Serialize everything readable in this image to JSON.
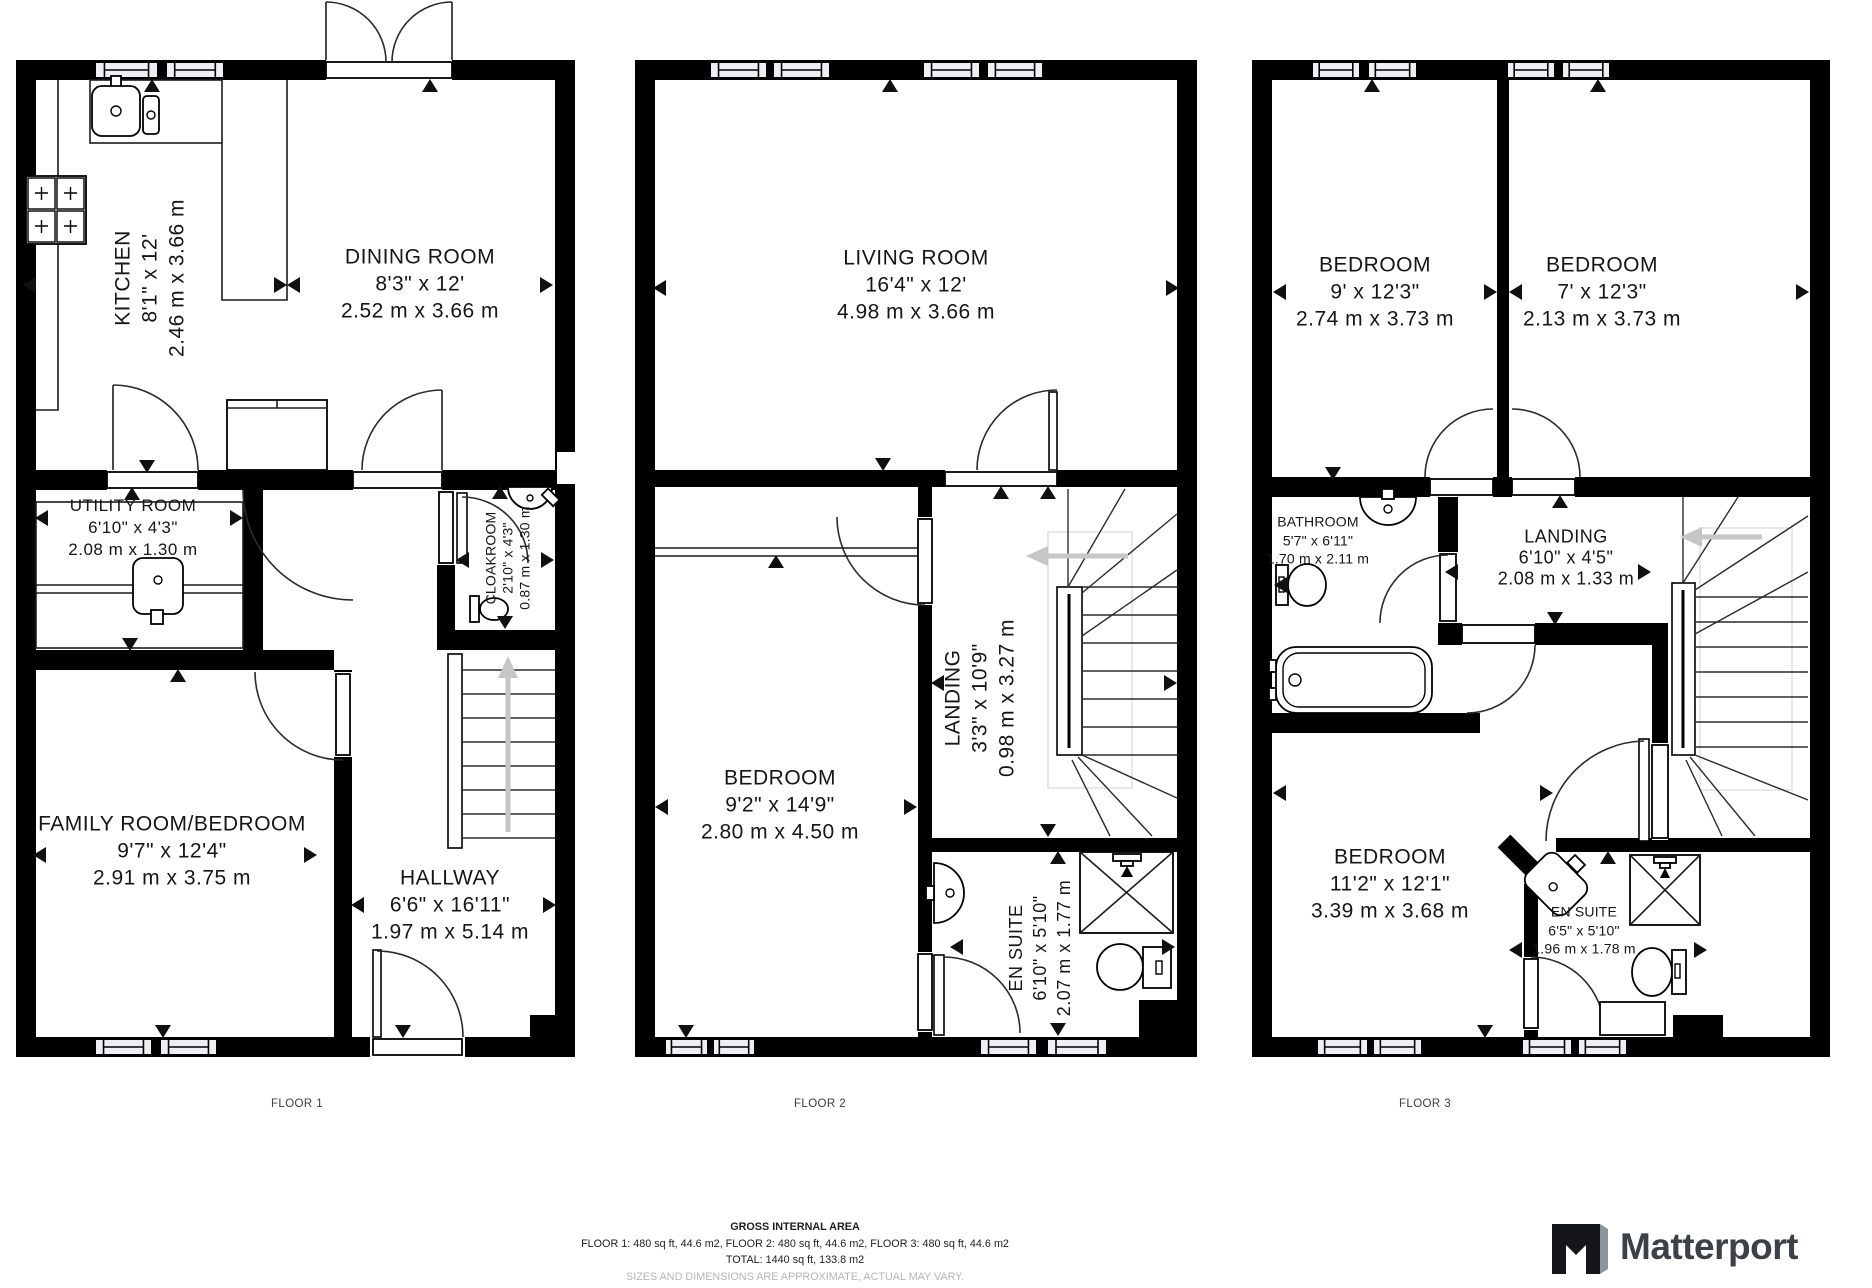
{
  "floors": [
    {
      "label": "FLOOR 1",
      "rooms": [
        {
          "name": "KITCHEN",
          "imperial": "8'1\" x 12'",
          "metric": "2.46 m x 3.66 m"
        },
        {
          "name": "DINING ROOM",
          "imperial": "8'3\" x 12'",
          "metric": "2.52 m x 3.66 m"
        },
        {
          "name": "UTILITY ROOM",
          "imperial": "6'10\" x 4'3\"",
          "metric": "2.08 m x 1.30 m"
        },
        {
          "name": "CLOAKROOM",
          "imperial": "2'10\" x 4'3\"",
          "metric": "0.87 m x 1.30 m"
        },
        {
          "name": "FAMILY ROOM/BEDROOM",
          "imperial": "9'7\" x 12'4\"",
          "metric": "2.91 m x 3.75 m"
        },
        {
          "name": "HALLWAY",
          "imperial": "6'6\" x 16'11\"",
          "metric": "1.97 m x 5.14 m"
        }
      ]
    },
    {
      "label": "FLOOR 2",
      "rooms": [
        {
          "name": "LIVING ROOM",
          "imperial": "16'4\" x 12'",
          "metric": "4.98 m x 3.66 m"
        },
        {
          "name": "BEDROOM",
          "imperial": "9'2\" x 14'9\"",
          "metric": "2.80 m x 4.50 m"
        },
        {
          "name": "LANDING",
          "imperial": "3'3\" x 10'9\"",
          "metric": "0.98 m x 3.27 m"
        },
        {
          "name": "EN SUITE",
          "imperial": "6'10\" x 5'10\"",
          "metric": "2.07 m x 1.77 m"
        }
      ]
    },
    {
      "label": "FLOOR 3",
      "rooms": [
        {
          "name": "BEDROOM",
          "imperial": "9' x 12'3\"",
          "metric": "2.74 m x 3.73 m"
        },
        {
          "name": "BEDROOM",
          "imperial": "7' x 12'3\"",
          "metric": "2.13 m x 3.73 m"
        },
        {
          "name": "BATHROOM",
          "imperial": "5'7\" x 6'11\"",
          "metric": "1.70 m x 2.11 m"
        },
        {
          "name": "LANDING",
          "imperial": "6'10\" x 4'5\"",
          "metric": "2.08 m x 1.33 m"
        },
        {
          "name": "BEDROOM",
          "imperial": "11'2\" x 12'1\"",
          "metric": "3.39 m x 3.68 m"
        },
        {
          "name": "EN SUITE",
          "imperial": "6'5\" x 5'10\"",
          "metric": "1.96 m x 1.78 m"
        }
      ]
    }
  ],
  "footer": {
    "title": "GROSS INTERNAL AREA",
    "line1": "FLOOR 1: 480 sq ft, 44.6 m2, FLOOR 2: 480 sq ft, 44.6 m2, FLOOR 3: 480 sq ft, 44.6 m2",
    "line2": "TOTAL: 1440 sq ft, 133.8 m2",
    "disclaimer": "SIZES AND DIMENSIONS ARE APPROXIMATE, ACTUAL MAY VARY."
  },
  "logo": {
    "text": "Matterport"
  },
  "colors": {
    "wall": "#000000",
    "window_fill": "#edeff5",
    "stair_arrow": "#c6c6c6",
    "logo_text": "#3b4147",
    "logo_gray": "#8f9498",
    "disclaimer": "#b3b6ba"
  }
}
